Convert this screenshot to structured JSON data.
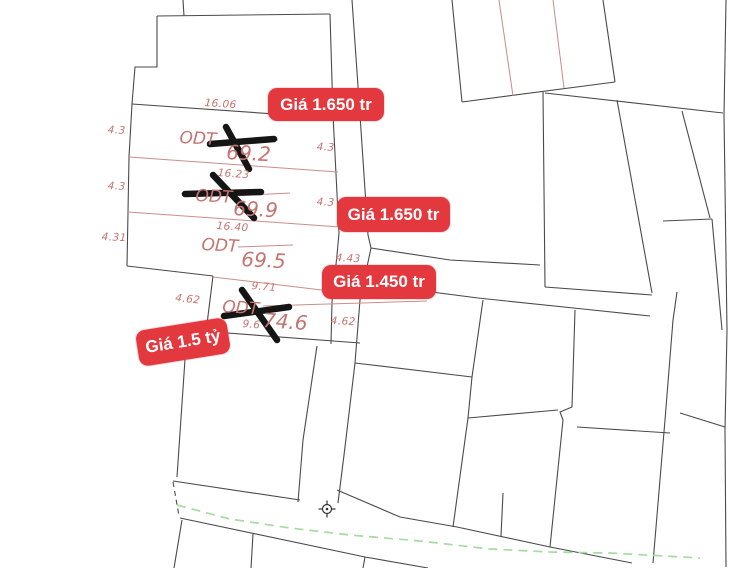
{
  "map": {
    "type": "cadastral-parcel-map",
    "colors": {
      "paper": "#ffffff",
      "parcel_line": "#4a4a4a",
      "pink_line": "#cb8e8a",
      "red_line": "#c98b8b",
      "pink_text": "#c5736f",
      "badge_red": "#e3383e",
      "road_green": "#a6dba1",
      "cross_black": "#151515"
    },
    "dimension_labels": [
      {
        "text": "16.06",
        "x": 205,
        "y": 97,
        "rot": 4
      },
      {
        "text": "4.3",
        "x": 108,
        "y": 124,
        "rot": 3
      },
      {
        "text": "4.3",
        "x": 317,
        "y": 141,
        "rot": 3
      },
      {
        "text": "16.23",
        "x": 218,
        "y": 167,
        "rot": 4
      },
      {
        "text": "4.3",
        "x": 108,
        "y": 180,
        "rot": 3
      },
      {
        "text": "4.3",
        "x": 317,
        "y": 196,
        "rot": 3
      },
      {
        "text": "16.40",
        "x": 217,
        "y": 220,
        "rot": 4
      },
      {
        "text": "4.31",
        "x": 102,
        "y": 231,
        "rot": 3
      },
      {
        "text": "4.43",
        "x": 336,
        "y": 252,
        "rot": 3
      },
      {
        "text": "9.71",
        "x": 252,
        "y": 280,
        "rot": 5
      },
      {
        "text": "4.62",
        "x": 176,
        "y": 292,
        "rot": 6
      },
      {
        "text": "4.62",
        "x": 331,
        "y": 315,
        "rot": 3
      },
      {
        "text": "9.6",
        "x": 243,
        "y": 318,
        "rot": 5
      }
    ],
    "parcel_labels": [
      {
        "zone": "ODT",
        "area": "69.2",
        "zone_x": 180,
        "zone_y": 128,
        "area_x": 227,
        "area_y": 140,
        "rot": 3,
        "crossed_out": true
      },
      {
        "zone": "ODT",
        "area": "69.9",
        "zone_x": 196,
        "zone_y": 186,
        "area_x": 234,
        "area_y": 196,
        "rot": 3,
        "crossed_out": true
      },
      {
        "zone": "ODT",
        "area": "69.5",
        "zone_x": 202,
        "zone_y": 235,
        "area_x": 242,
        "area_y": 247,
        "rot": 3,
        "crossed_out": false
      },
      {
        "zone": "ODT",
        "area": "74.6",
        "zone_x": 223,
        "zone_y": 297,
        "area_x": 264,
        "area_y": 308,
        "rot": 4,
        "crossed_out": true
      }
    ],
    "price_badges": [
      {
        "text": "Giá 1.650 tr",
        "x": 268,
        "y": 88,
        "w": 116,
        "h": 33,
        "rot": 0
      },
      {
        "text": "Giá 1.650 tr",
        "x": 337,
        "y": 197,
        "w": 113,
        "h": 35,
        "rot": 0
      },
      {
        "text": "Giá 1.450 tr",
        "x": 322,
        "y": 265,
        "w": 114,
        "h": 34,
        "rot": 0
      },
      {
        "text": "Giá 1.5 tỷ",
        "x": 137,
        "y": 324,
        "w": 92,
        "h": 36,
        "rot": -9
      }
    ]
  }
}
